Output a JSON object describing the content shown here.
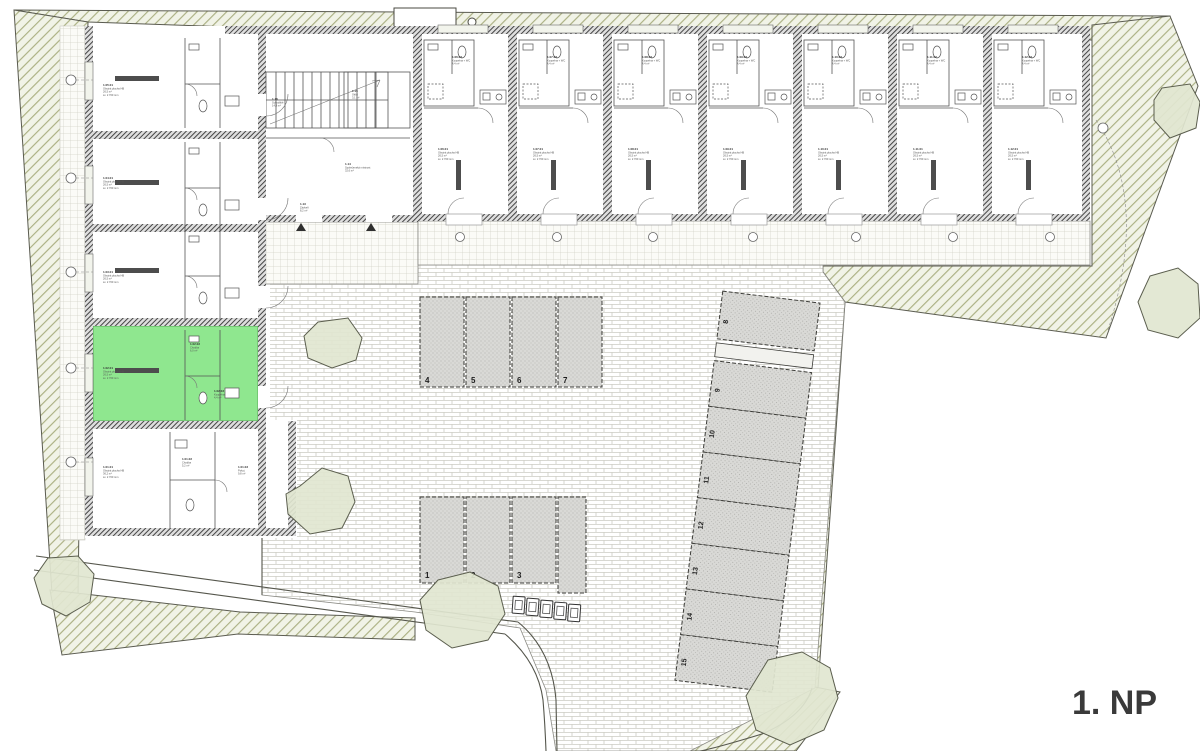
{
  "title": "1. NP",
  "colors": {
    "highlight_green": "#8fe78f",
    "site_hatch_line": "#a8ad7e",
    "wall_gray": "#4a4a4a"
  },
  "parking": {
    "row_top": [
      {
        "label": "4",
        "x": 420,
        "y": 297,
        "w": 44,
        "h": 90,
        "tx": 425,
        "ty": 383
      },
      {
        "label": "5",
        "x": 466,
        "y": 297,
        "w": 44,
        "h": 90,
        "tx": 471,
        "ty": 383
      },
      {
        "label": "6",
        "x": 512,
        "y": 297,
        "w": 44,
        "h": 90,
        "tx": 517,
        "ty": 383
      },
      {
        "label": "7",
        "x": 558,
        "y": 297,
        "w": 44,
        "h": 90,
        "tx": 563,
        "ty": 383
      }
    ],
    "row_bottom": [
      {
        "label": "1",
        "x": 420,
        "y": 497,
        "w": 44,
        "h": 86,
        "tx": 425,
        "ty": 578
      },
      {
        "label": "2",
        "x": 466,
        "y": 497,
        "w": 44,
        "h": 86,
        "tx": 471,
        "ty": 578
      },
      {
        "label": "3",
        "x": 512,
        "y": 497,
        "w": 44,
        "h": 86,
        "tx": 517,
        "ty": 578
      }
    ],
    "column": [
      {
        "label": "8",
        "y": 297,
        "h": 48,
        "tf": "translate(731,329) rotate(-90)"
      },
      {
        "label": "9",
        "y": 367,
        "h": 46,
        "tf": "translate(731,398) rotate(-90)"
      },
      {
        "label": "10",
        "y": 413,
        "h": 46,
        "tf": "translate(731,444) rotate(-90)"
      },
      {
        "label": "11",
        "y": 459,
        "h": 46,
        "tf": "translate(731,490) rotate(-90)"
      },
      {
        "label": "12",
        "y": 505,
        "h": 46,
        "tf": "translate(731,536) rotate(-90)"
      },
      {
        "label": "13",
        "y": 551,
        "h": 46,
        "tf": "translate(731,582) rotate(-90)"
      },
      {
        "label": "14",
        "y": 597,
        "h": 46,
        "tf": "translate(731,628) rotate(-90)"
      },
      {
        "label": "15",
        "y": 643,
        "h": 46,
        "tf": "translate(731,674) rotate(-90)"
      }
    ],
    "bins": [
      {
        "x": 513,
        "y": 598
      },
      {
        "x": 527,
        "y": 599
      },
      {
        "x": 541,
        "y": 600
      },
      {
        "x": 555,
        "y": 601
      },
      {
        "x": 569,
        "y": 602
      }
    ]
  },
  "rooms": {
    "living_top": [
      {
        "tf": "translate(438,150)",
        "num": "1.06.01",
        "name": "Obytná plocha HB",
        "area": "26,5 m²",
        "h": "sv. 2 700 mm"
      },
      {
        "tf": "translate(533,150)",
        "num": "1.07.01",
        "name": "Obytná plocha HB",
        "area": "26,5 m²",
        "h": "sv. 2 700 mm"
      },
      {
        "tf": "translate(628,150)",
        "num": "1.08.01",
        "name": "Obytná plocha HB",
        "area": "26,5 m²",
        "h": "sv. 2 700 mm"
      },
      {
        "tf": "translate(723,150)",
        "num": "1.09.01",
        "name": "Obytná plocha HB",
        "area": "26,5 m²",
        "h": "sv. 2 700 mm"
      },
      {
        "tf": "translate(818,150)",
        "num": "1.10.01",
        "name": "Obytná plocha HB",
        "area": "26,5 m²",
        "h": "sv. 2 700 mm"
      },
      {
        "tf": "translate(913,150)",
        "num": "1.11.01",
        "name": "Obytná plocha HB",
        "area": "26,5 m²",
        "h": "sv. 2 700 mm"
      },
      {
        "tf": "translate(1008,150)",
        "num": "1.12.01",
        "name": "Obytná plocha HB",
        "area": "26,5 m²",
        "h": "sv. 2 700 mm"
      }
    ],
    "bath_top": [
      {
        "tf": "translate(452,58)",
        "num": "1.06.02",
        "name": "Koupelna + WC",
        "area": "4,4 m²",
        "h": ""
      },
      {
        "tf": "translate(547,58)",
        "num": "1.07.02",
        "name": "Koupelna + WC",
        "area": "4,4 m²",
        "h": ""
      },
      {
        "tf": "translate(642,58)",
        "num": "1.08.02",
        "name": "Koupelna + WC",
        "area": "4,4 m²",
        "h": ""
      },
      {
        "tf": "translate(737,58)",
        "num": "1.09.02",
        "name": "Koupelna + WC",
        "area": "4,4 m²",
        "h": ""
      },
      {
        "tf": "translate(832,58)",
        "num": "1.10.02",
        "name": "Koupelna + WC",
        "area": "4,4 m²",
        "h": ""
      },
      {
        "tf": "translate(927,58)",
        "num": "1.11.02",
        "name": "Koupelna + WC",
        "area": "4,4 m²",
        "h": ""
      },
      {
        "tf": "translate(1022,58)",
        "num": "1.12.02",
        "name": "Koupelna + WC",
        "area": "4,4 m²",
        "h": ""
      }
    ],
    "left_wing": [
      {
        "tf": "translate(103,86)",
        "num": "1.05.01",
        "name": "Obytná plocha HB",
        "area": "26,5 m²",
        "h": "sv. 2 700 mm"
      },
      {
        "tf": "translate(103,179)",
        "num": "1.04.01",
        "name": "Obytná plocha HB",
        "area": "26,5 m²",
        "h": "sv. 2 700 mm"
      },
      {
        "tf": "translate(103,273)",
        "num": "1.03.01",
        "name": "Obytná plocha HB",
        "area": "26,5 m²",
        "h": "sv. 2 700 mm"
      },
      {
        "tf": "translate(103,369)",
        "num": "1.02.01",
        "name": "Obytná plocha HB",
        "area": "26,5 m²",
        "h": "sv. 2 700 mm"
      },
      {
        "tf": "translate(103,468)",
        "num": "1.01.01",
        "name": "Obytná plocha HB",
        "area": "36,2 m²",
        "h": "sv. 2 700 mm"
      }
    ],
    "small_labels": [
      {
        "tf": "translate(190,345)",
        "num": "1.02.02",
        "name": "Chodba",
        "area": "6,0 m²",
        "h": ""
      },
      {
        "tf": "translate(214,392)",
        "num": "1.02.03",
        "name": "Koupelna",
        "area": "4,4 m²",
        "h": ""
      },
      {
        "tf": "translate(272,100)",
        "num": "1.16",
        "name": "Schodiště",
        "area": "14,8 m²",
        "h": ""
      },
      {
        "tf": "translate(352,92)",
        "num": "1.15",
        "name": "Úklid",
        "area": "3,1 m²",
        "h": ""
      },
      {
        "tf": "translate(345,165)",
        "num": "1.14",
        "name": "Společenská místnost",
        "area": "32,6 m²",
        "h": "sv. 2 700 mm"
      },
      {
        "tf": "translate(300,205)",
        "num": "1.13",
        "name": "Zádveří",
        "area": "8,2 m²",
        "h": ""
      },
      {
        "tf": "translate(182,460)",
        "num": "1.01.02",
        "name": "Chodba",
        "area": "5,2 m²",
        "h": ""
      },
      {
        "tf": "translate(238,468)",
        "num": "1.01.03",
        "name": "Pokoj",
        "area": "9,8 m²",
        "h": ""
      }
    ]
  }
}
